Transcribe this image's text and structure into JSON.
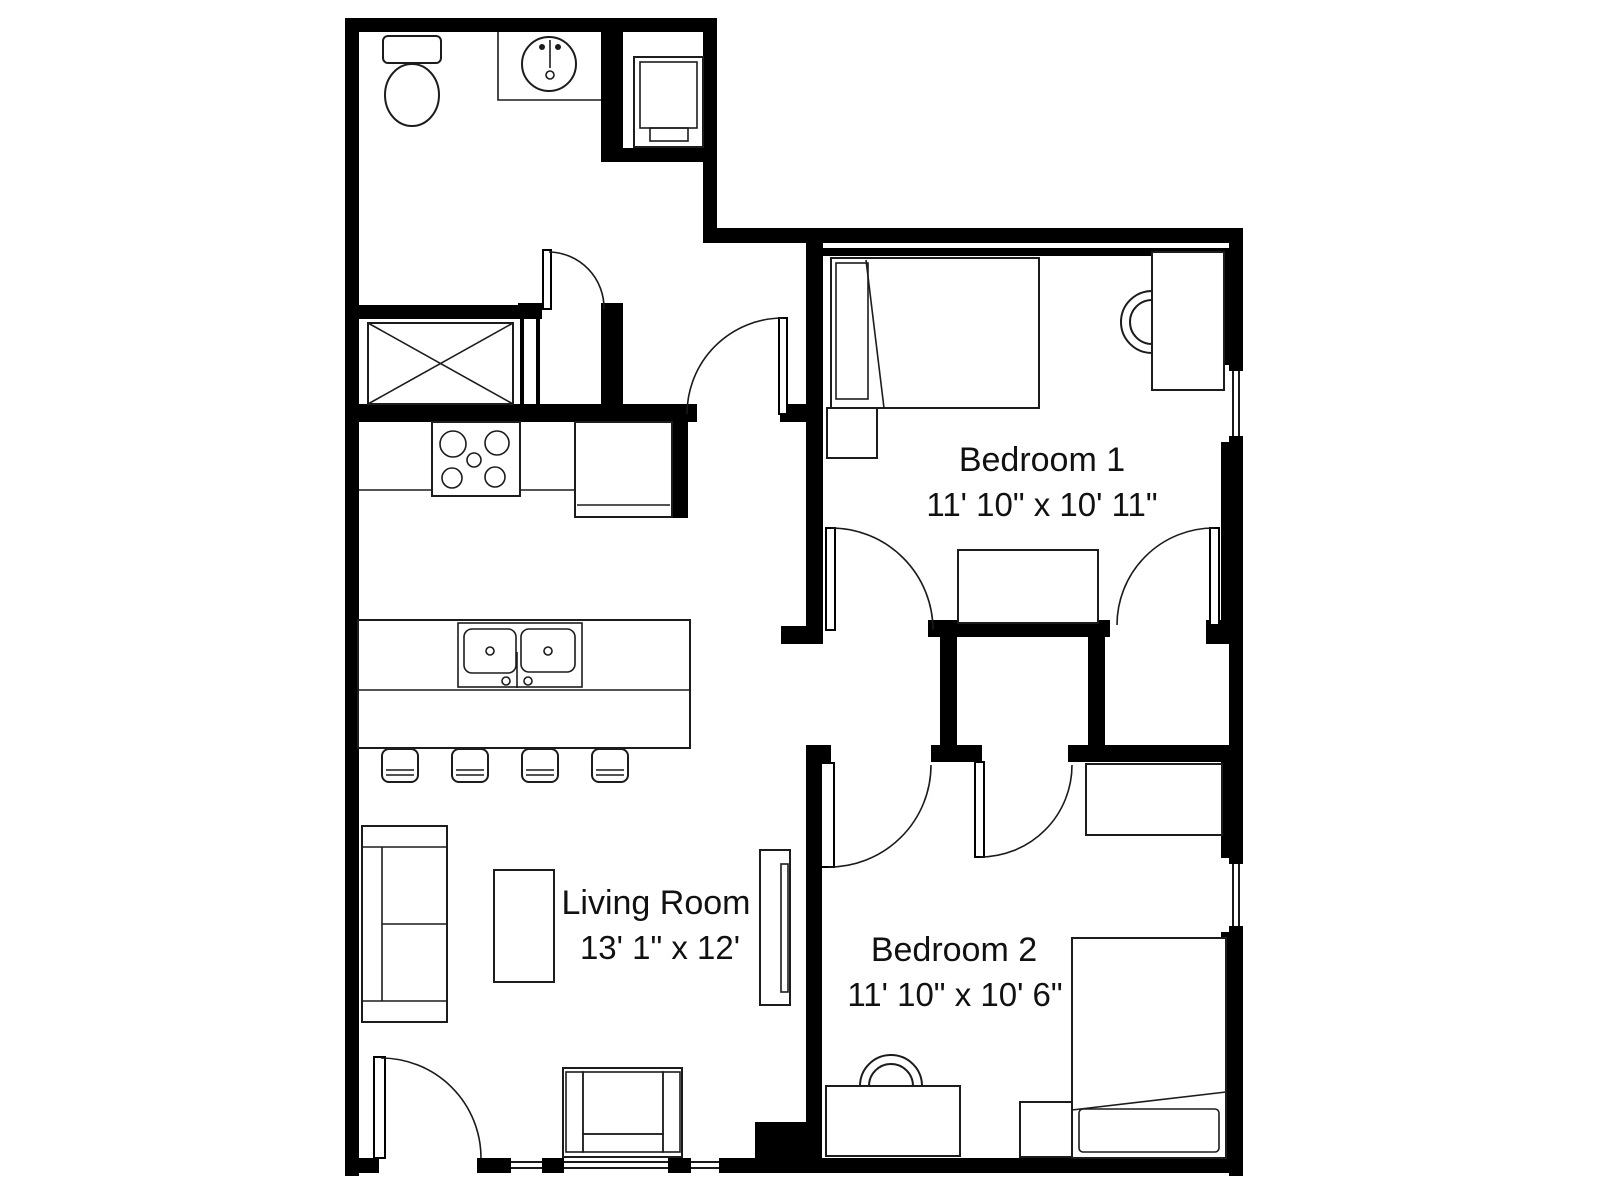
{
  "plan_type": "apartment-floor-plan",
  "colors": {
    "background": "#ffffff",
    "walls": "#000000",
    "text": "#111111"
  },
  "rooms": [
    {
      "id": "living-room",
      "name": "Living Room",
      "dimensions": "13' 1\" x 12'"
    },
    {
      "id": "bedroom-1",
      "name": "Bedroom 1",
      "dimensions": "11' 10\" x 10' 11\""
    },
    {
      "id": "bedroom-2",
      "name": "Bedroom 2",
      "dimensions": "11' 10\" x 10' 6\""
    }
  ],
  "fixtures": {
    "toilet": "toilet",
    "bathroom-sink": "bathroom sink with faucet",
    "washer-dryer": "washer/dryer unit",
    "shower": "shower / mechanical space (X symbol)",
    "stove": "range with 4 burners",
    "refrigerator": "refrigerator",
    "kitchen-counter": "kitchen counter",
    "kitchen-island": "kitchen island",
    "double-sink": "double basin kitchen sink",
    "bar-stool": "bar stool (4 total)",
    "sofa": "sofa",
    "coffee-table": "coffee table",
    "tv-stand": "tv stand with television",
    "armchair": "armchair",
    "bed": "twin bed (one per bedroom)",
    "nightstand": "nightstand (one per bedroom)",
    "desk": "desk (one per bedroom)",
    "desk-chair": "desk chair (one per bedroom)",
    "dresser": "dresser (one per bedroom)",
    "door": "swing door (7 total)",
    "window": "window (5 total)"
  }
}
